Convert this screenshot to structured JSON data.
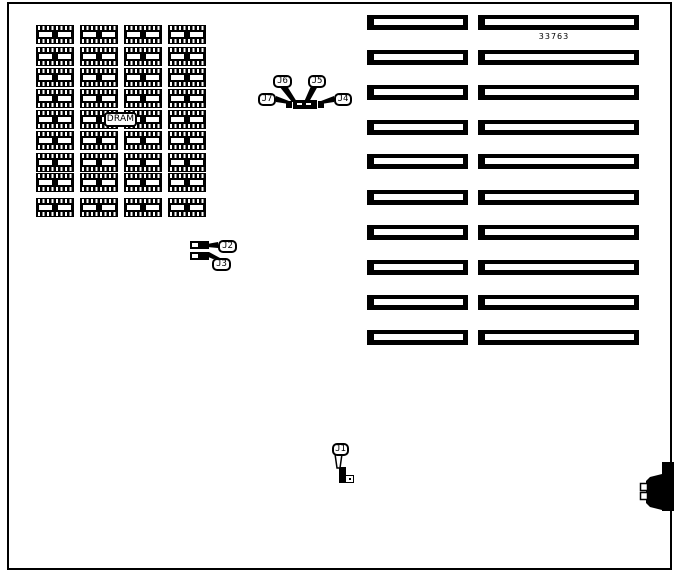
{
  "labels": {
    "part_number": "33763",
    "dram": "DRAM",
    "j1": "J1",
    "j2": "J2",
    "j3": "J3",
    "j4": "J4",
    "j5": "J5",
    "j6": "J6",
    "j7": "J7"
  },
  "components": {
    "dram_grid": {
      "rows": 9,
      "cols": 4
    },
    "expansion_slots": {
      "rows": 10,
      "columns": 2
    },
    "jumpers": [
      "J1",
      "J2",
      "J3",
      "J4",
      "J5",
      "J6",
      "J7"
    ]
  }
}
